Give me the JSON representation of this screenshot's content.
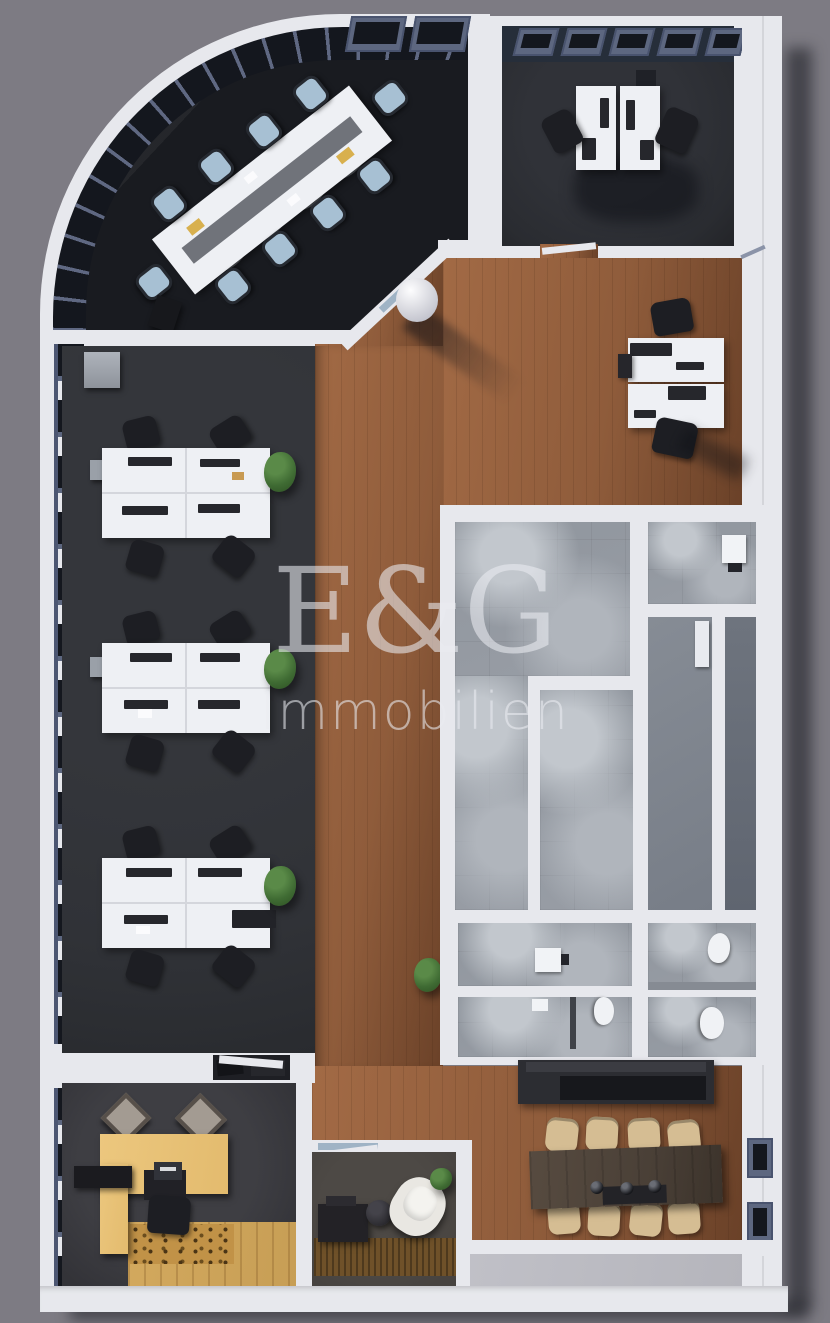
{
  "watermark": {
    "line1": "E&G",
    "line2": "Immobilien"
  },
  "palette": {
    "bg": "#7d7b83",
    "wall": "#e7e8ed",
    "wall-bright": "#f3f4f8",
    "wall-shade": "#c6c8d2",
    "shadow-navy": "#20253a",
    "gloss-floor": "#191b20",
    "charcoal": "#303237",
    "charcoal-deep": "#2a2c31",
    "wood": "#8f5c3b",
    "wood-light": "#a26a45",
    "wood-dark": "#6a4128",
    "slate": "#5d6780",
    "glass": "#14171e",
    "core-gray": "#989da5",
    "core-light": "#c2c7cd",
    "core-dark": "#6e747e",
    "desk-white": "#eef0f4",
    "chair-black": "#1d1e23",
    "chair-blue": "#a7c0d3",
    "chair-beige": "#d5bd93",
    "dining-table": "#4a4037",
    "maple": "#e3bb6e",
    "reception-wood": "#c79e55",
    "rug-tan": "#c19247",
    "lounge-floor": "#474340",
    "lounge-rug": "#6f5129",
    "terrace": "#b5b5bc",
    "plant": "#3f6b33",
    "white-chair": "#e9e7e2",
    "monitor": "#26272c",
    "watermark": "rgba(235,236,241,0.58)"
  }
}
